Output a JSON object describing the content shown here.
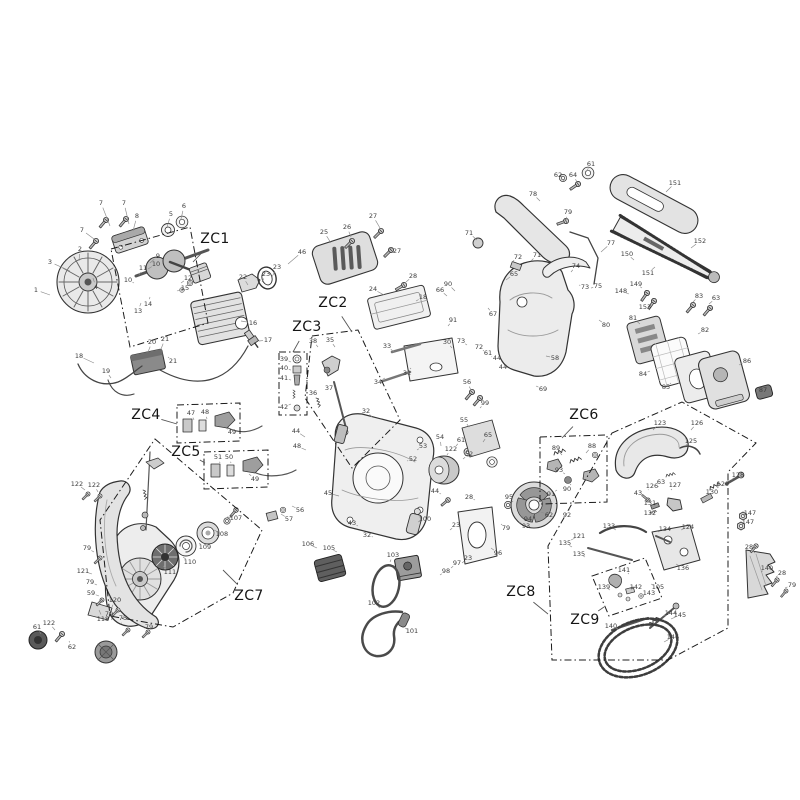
{
  "diagram": {
    "background": "#ffffff",
    "stroke_color": "#333333",
    "label_color": "#3c3c3c",
    "leader_color": "#8a8a8a",
    "zone_color": "#1c1c1c",
    "zone_dash": "7 3 1.5 3",
    "zones": [
      {
        "label": "ZC1",
        "x": 215,
        "y": 239,
        "tx": 193,
        "ty": 262,
        "outline": [
          [
            111,
            249
          ],
          [
            190,
            227
          ],
          [
            208,
            323
          ],
          [
            130,
            347
          ]
        ]
      },
      {
        "label": "ZC2",
        "x": 333,
        "y": 303,
        "tx": 352,
        "ty": 332,
        "outline": [
          [
            312,
            336
          ],
          [
            358,
            330
          ],
          [
            400,
            420
          ],
          [
            352,
            468
          ],
          [
            305,
            398
          ]
        ]
      },
      {
        "label": "ZC3",
        "x": 307,
        "y": 327,
        "tx": 293,
        "ty": 352,
        "outline": [
          [
            279,
            352
          ],
          [
            307,
            352
          ],
          [
            307,
            415
          ],
          [
            279,
            415
          ]
        ]
      },
      {
        "label": "ZC4",
        "x": 146,
        "y": 415,
        "tx": 177,
        "ty": 424,
        "outline": [
          [
            177,
            405
          ],
          [
            240,
            403
          ],
          [
            240,
            441
          ],
          [
            177,
            443
          ]
        ]
      },
      {
        "label": "ZC5",
        "x": 186,
        "y": 452,
        "tx": 205,
        "ty": 463,
        "outline": [
          [
            204,
            452
          ],
          [
            268,
            450
          ],
          [
            268,
            487
          ],
          [
            204,
            489
          ]
        ]
      },
      {
        "label": "ZC6",
        "x": 584,
        "y": 415,
        "tx": 562,
        "ty": 438,
        "outline": [
          [
            540,
            437
          ],
          [
            607,
            435
          ],
          [
            607,
            502
          ],
          [
            540,
            504
          ]
        ]
      },
      {
        "label": "ZC7",
        "x": 249,
        "y": 596,
        "tx": 223,
        "ty": 570,
        "outline": [
          [
            155,
            439
          ],
          [
            262,
            530
          ],
          [
            233,
            593
          ],
          [
            173,
            627
          ],
          [
            110,
            616
          ],
          [
            100,
            520
          ]
        ]
      },
      {
        "label": "ZC8",
        "x": 521,
        "y": 592,
        "tx": 548,
        "ty": 614,
        "outline": [
          [
            612,
            433
          ],
          [
            682,
            402
          ],
          [
            756,
            443
          ],
          [
            728,
            472
          ],
          [
            728,
            628
          ],
          [
            668,
            660
          ],
          [
            552,
            660
          ],
          [
            548,
            546
          ]
        ]
      },
      {
        "label": "ZC9",
        "x": 585,
        "y": 620,
        "tx": 604,
        "ty": 607,
        "outline": [
          [
            592,
            576
          ],
          [
            645,
            558
          ],
          [
            662,
            598
          ],
          [
            609,
            616
          ]
        ]
      }
    ],
    "part_labels": [
      [
        "7",
        101,
        203,
        110,
        226
      ],
      [
        "7",
        124,
        203,
        129,
        224
      ],
      [
        "8",
        137,
        216,
        133,
        231
      ],
      [
        "7",
        82,
        230,
        94,
        239
      ],
      [
        "5",
        171,
        214,
        167,
        227
      ],
      [
        "6",
        184,
        206,
        181,
        219
      ],
      [
        "2",
        80,
        249,
        79,
        261
      ],
      [
        "3",
        50,
        262,
        70,
        271
      ],
      [
        "1",
        36,
        290,
        50,
        295
      ],
      [
        "4",
        96,
        287,
        93,
        278
      ],
      [
        "9",
        158,
        256,
        150,
        263
      ],
      [
        "10",
        156,
        264,
        148,
        269
      ],
      [
        "11",
        143,
        268,
        139,
        275
      ],
      [
        "10",
        128,
        280,
        134,
        283
      ],
      [
        "12",
        188,
        278,
        181,
        283
      ],
      [
        "15",
        185,
        288,
        177,
        291
      ],
      [
        "14",
        148,
        304,
        150,
        297
      ],
      [
        "13",
        138,
        311,
        141,
        303
      ],
      [
        "16",
        253,
        323,
        241,
        321
      ],
      [
        "17",
        268,
        340,
        259,
        341
      ],
      [
        "18",
        79,
        356,
        94,
        363
      ],
      [
        "19",
        106,
        371,
        111,
        378
      ],
      [
        "20",
        152,
        342,
        148,
        352
      ],
      [
        "21",
        165,
        339,
        161,
        349
      ],
      [
        "21",
        173,
        361,
        168,
        357
      ],
      [
        "22",
        243,
        277,
        248,
        285
      ],
      [
        "23",
        266,
        274,
        262,
        282
      ],
      [
        "23",
        277,
        267,
        272,
        277
      ],
      [
        "46",
        302,
        252,
        288,
        264
      ],
      [
        "25",
        324,
        232,
        331,
        243
      ],
      [
        "26",
        347,
        227,
        351,
        237
      ],
      [
        "27",
        373,
        216,
        380,
        228
      ],
      [
        "27",
        397,
        251,
        390,
        248
      ],
      [
        "28",
        413,
        276,
        406,
        282
      ],
      [
        "24",
        373,
        289,
        384,
        295
      ],
      [
        "18",
        423,
        297,
        416,
        301
      ],
      [
        "66",
        440,
        290,
        447,
        296
      ],
      [
        "90",
        448,
        284,
        455,
        291
      ],
      [
        "65",
        514,
        274,
        506,
        280
      ],
      [
        "91",
        453,
        320,
        448,
        326
      ],
      [
        "30",
        447,
        342,
        452,
        348
      ],
      [
        "73",
        461,
        341,
        467,
        345
      ],
      [
        "72",
        479,
        347,
        484,
        351
      ],
      [
        "61",
        488,
        353,
        492,
        357
      ],
      [
        "44",
        497,
        358,
        500,
        362
      ],
      [
        "44",
        503,
        367,
        506,
        371
      ],
      [
        "67",
        493,
        314,
        488,
        308
      ],
      [
        "58",
        555,
        358,
        546,
        356
      ],
      [
        "69",
        543,
        389,
        536,
        386
      ],
      [
        "33",
        387,
        346,
        394,
        352
      ],
      [
        "31",
        407,
        373,
        411,
        368
      ],
      [
        "34",
        378,
        382,
        385,
        378
      ],
      [
        "32",
        366,
        411,
        372,
        417
      ],
      [
        "35",
        330,
        340,
        335,
        347
      ],
      [
        "38",
        313,
        341,
        318,
        347
      ],
      [
        "37",
        329,
        388,
        331,
        384
      ],
      [
        "36",
        313,
        393,
        317,
        390
      ],
      [
        "39",
        284,
        359,
        291,
        362
      ],
      [
        "40",
        284,
        368,
        291,
        370
      ],
      [
        "41",
        284,
        378,
        291,
        380
      ],
      [
        "42",
        284,
        407,
        291,
        404
      ],
      [
        "62",
        558,
        175,
        564,
        181
      ],
      [
        "64",
        573,
        175,
        577,
        182
      ],
      [
        "61",
        591,
        164,
        586,
        172
      ],
      [
        "78",
        533,
        194,
        540,
        201
      ],
      [
        "79",
        568,
        212,
        566,
        220
      ],
      [
        "71",
        469,
        233,
        477,
        240
      ],
      [
        "72",
        518,
        257,
        512,
        262
      ],
      [
        "71",
        537,
        255,
        531,
        261
      ],
      [
        "77",
        611,
        243,
        601,
        252
      ],
      [
        "74",
        576,
        266,
        571,
        272
      ],
      [
        "73",
        585,
        287,
        579,
        285
      ],
      [
        "75",
        598,
        286,
        591,
        288
      ],
      [
        "80",
        606,
        325,
        599,
        320
      ],
      [
        "151",
        675,
        183,
        666,
        192
      ],
      [
        "152",
        700,
        241,
        691,
        248
      ],
      [
        "151",
        648,
        273,
        655,
        267
      ],
      [
        "150",
        627,
        254,
        634,
        260
      ],
      [
        "148",
        621,
        291,
        629,
        294
      ],
      [
        "149",
        636,
        284,
        642,
        288
      ],
      [
        "153",
        645,
        307,
        650,
        310
      ],
      [
        "83",
        699,
        296,
        693,
        302
      ],
      [
        "63",
        716,
        298,
        709,
        304
      ],
      [
        "81",
        633,
        318,
        640,
        324
      ],
      [
        "82",
        705,
        330,
        698,
        334
      ],
      [
        "84",
        643,
        374,
        650,
        371
      ],
      [
        "85",
        666,
        387,
        671,
        383
      ],
      [
        "86",
        747,
        361,
        739,
        365
      ],
      [
        "87",
        763,
        390,
        757,
        391
      ],
      [
        "44",
        296,
        431,
        305,
        437
      ],
      [
        "48",
        297,
        446,
        306,
        450
      ],
      [
        "45",
        328,
        493,
        339,
        496
      ],
      [
        "43",
        352,
        523,
        358,
        526
      ],
      [
        "32",
        367,
        535,
        373,
        537
      ],
      [
        "106",
        308,
        544,
        317,
        548
      ],
      [
        "105",
        329,
        548,
        337,
        552
      ],
      [
        "53",
        423,
        446,
        417,
        450
      ],
      [
        "52",
        413,
        459,
        407,
        461
      ],
      [
        "55",
        464,
        420,
        469,
        427
      ],
      [
        "56",
        467,
        382,
        471,
        390
      ],
      [
        "99",
        485,
        403,
        480,
        408
      ],
      [
        "23",
        456,
        525,
        450,
        530
      ],
      [
        "96",
        498,
        553,
        491,
        548
      ],
      [
        "100",
        425,
        519,
        418,
        522
      ],
      [
        "103",
        393,
        555,
        390,
        562
      ],
      [
        "102",
        374,
        603,
        380,
        608
      ],
      [
        "101",
        412,
        631,
        405,
        628
      ],
      [
        "98",
        446,
        571,
        440,
        575
      ],
      [
        "97",
        457,
        563,
        451,
        568
      ],
      [
        "23",
        468,
        558,
        462,
        563
      ],
      [
        "61",
        461,
        440,
        456,
        446
      ],
      [
        "122",
        451,
        449,
        447,
        455
      ],
      [
        "54",
        440,
        437,
        441,
        446
      ],
      [
        "65",
        488,
        435,
        483,
        442
      ],
      [
        "52",
        469,
        454,
        463,
        459
      ],
      [
        "28",
        469,
        497,
        475,
        500
      ],
      [
        "44",
        435,
        491,
        441,
        494
      ],
      [
        "95",
        509,
        497,
        513,
        502
      ],
      [
        "94",
        528,
        519,
        522,
        516
      ],
      [
        "93",
        526,
        526,
        519,
        522
      ],
      [
        "79",
        506,
        528,
        501,
        524
      ],
      [
        "62",
        549,
        515,
        541,
        512
      ],
      [
        "89",
        556,
        448,
        562,
        455
      ],
      [
        "88",
        592,
        446,
        586,
        453
      ],
      [
        "93",
        559,
        470,
        565,
        474
      ],
      [
        "90",
        567,
        489,
        571,
        484
      ],
      [
        "91",
        551,
        494,
        557,
        490
      ],
      [
        "92",
        567,
        515,
        570,
        508
      ],
      [
        "123",
        660,
        423,
        653,
        430
      ],
      [
        "126",
        697,
        423,
        691,
        430
      ],
      [
        "125",
        691,
        441,
        685,
        446
      ],
      [
        "128",
        738,
        475,
        731,
        480
      ],
      [
        "129",
        723,
        484,
        717,
        488
      ],
      [
        "130",
        712,
        492,
        706,
        494
      ],
      [
        "126",
        652,
        486,
        648,
        490
      ],
      [
        "63",
        661,
        482,
        658,
        487
      ],
      [
        "127",
        675,
        485,
        671,
        490
      ],
      [
        "43",
        638,
        493,
        643,
        497
      ],
      [
        "131",
        650,
        503,
        655,
        506
      ],
      [
        "132",
        650,
        513,
        655,
        515
      ],
      [
        "147",
        750,
        513,
        743,
        516
      ],
      [
        "147",
        748,
        522,
        741,
        525
      ],
      [
        "133",
        609,
        526,
        616,
        530
      ],
      [
        "134",
        665,
        529,
        658,
        532
      ],
      [
        "124",
        688,
        527,
        681,
        530
      ],
      [
        "135",
        565,
        543,
        572,
        547
      ],
      [
        "135",
        579,
        554,
        585,
        557
      ],
      [
        "121",
        579,
        536,
        571,
        540
      ],
      [
        "136",
        683,
        568,
        676,
        564
      ],
      [
        "141",
        624,
        570,
        629,
        574
      ],
      [
        "105",
        658,
        587,
        651,
        584
      ],
      [
        "139",
        604,
        587,
        610,
        590
      ],
      [
        "142",
        636,
        587,
        631,
        590
      ],
      [
        "143",
        649,
        593,
        644,
        595
      ],
      [
        "144",
        671,
        613,
        663,
        616
      ],
      [
        "140",
        611,
        626,
        618,
        629
      ],
      [
        "145",
        680,
        615,
        671,
        619
      ],
      [
        "146",
        673,
        637,
        664,
        642
      ],
      [
        "28",
        749,
        547,
        755,
        553
      ],
      [
        "140",
        767,
        568,
        761,
        572
      ],
      [
        "28",
        782,
        573,
        776,
        577
      ],
      [
        "79",
        792,
        585,
        785,
        588
      ],
      [
        "122",
        77,
        484,
        85,
        490
      ],
      [
        "122",
        94,
        485,
        98,
        492
      ],
      [
        "79",
        87,
        548,
        94,
        552
      ],
      [
        "121",
        83,
        571,
        92,
        574
      ],
      [
        "79",
        90,
        582,
        97,
        585
      ],
      [
        "59",
        91,
        593,
        99,
        596
      ],
      [
        "120",
        115,
        600,
        112,
        607
      ],
      [
        "118",
        103,
        619,
        99,
        610
      ],
      [
        "79",
        109,
        614,
        112,
        620
      ],
      [
        "75",
        123,
        618,
        121,
        624
      ],
      [
        "79",
        149,
        627,
        144,
        629
      ],
      [
        "61",
        37,
        627,
        41,
        634
      ],
      [
        "122",
        49,
        623,
        55,
        630
      ],
      [
        "62",
        72,
        647,
        69,
        641
      ],
      [
        "111",
        170,
        572,
        163,
        566
      ],
      [
        "110",
        190,
        562,
        183,
        557
      ],
      [
        "109",
        205,
        547,
        199,
        543
      ],
      [
        "108",
        222,
        534,
        214,
        530
      ],
      [
        "107",
        236,
        518,
        227,
        517
      ],
      [
        "57",
        289,
        519,
        281,
        514
      ],
      [
        "56",
        300,
        510,
        292,
        506
      ],
      [
        "47",
        191,
        413,
        194,
        420
      ],
      [
        "48",
        205,
        412,
        207,
        419
      ],
      [
        "49",
        232,
        432,
        226,
        428
      ],
      [
        "51",
        218,
        457,
        220,
        463
      ],
      [
        "50",
        229,
        457,
        231,
        463
      ],
      [
        "49",
        255,
        479,
        249,
        474
      ]
    ]
  }
}
